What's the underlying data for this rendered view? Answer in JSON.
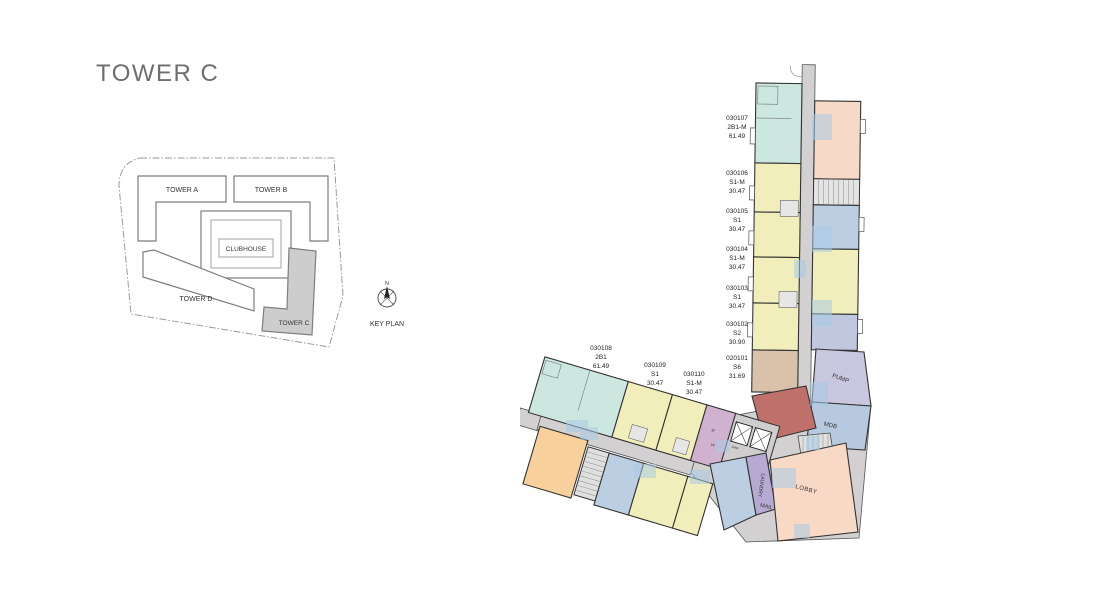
{
  "title": "TOWER C",
  "key_plan": {
    "caption": "KEY PLAN",
    "north": "N",
    "tower_a": "TOWER A",
    "tower_b": "TOWER B",
    "clubhouse": "CLUBHOUSE",
    "tower_d": "TOWER D",
    "tower_c": "TOWER C"
  },
  "units": [
    {
      "id": "030107",
      "type": "2B1-M",
      "area": "61.49"
    },
    {
      "id": "030106",
      "type": "S1-M",
      "area": "30.47"
    },
    {
      "id": "030105",
      "type": "S1",
      "area": "30.47"
    },
    {
      "id": "030104",
      "type": "S1-M",
      "area": "30.47"
    },
    {
      "id": "030103",
      "type": "S1",
      "area": "30.47"
    },
    {
      "id": "030102",
      "type": "S2",
      "area": "30.90"
    },
    {
      "id": "020101",
      "type": "S6",
      "area": "31.69"
    },
    {
      "id": "030108",
      "type": "2B1",
      "area": "61.49"
    },
    {
      "id": "030109",
      "type": "S1",
      "area": "30.47"
    },
    {
      "id": "030110",
      "type": "S1-M",
      "area": "30.47"
    }
  ],
  "rooms": {
    "pump": "PUMP",
    "mdb": "MDB",
    "lobby": "LOBBY",
    "mail": "MAIL",
    "laundry": "LAUNDRY",
    "ee": "EE",
    "gar": "GAR",
    "m": "M",
    "w": "W"
  },
  "colors": {
    "unit_teal": "#cbe7e0",
    "unit_yellow": "#f2eebb",
    "unit_salmon": "#f7d9c7",
    "unit_blue": "#bccfe2",
    "unit_lavender": "#c9c6e0",
    "unit_purple": "#d0b1cf",
    "unit_tan": "#d9c1ac",
    "unit_maroon": "#c0706a",
    "unit_orange": "#f8d09b",
    "lobby_peach": "#f7d9c5",
    "laundry_purple": "#b6aad2",
    "corridor_gray": "#d2d0d0",
    "balcony_blue": "#a9cbe6",
    "keyplan_highlight": "#cdcdcd"
  }
}
